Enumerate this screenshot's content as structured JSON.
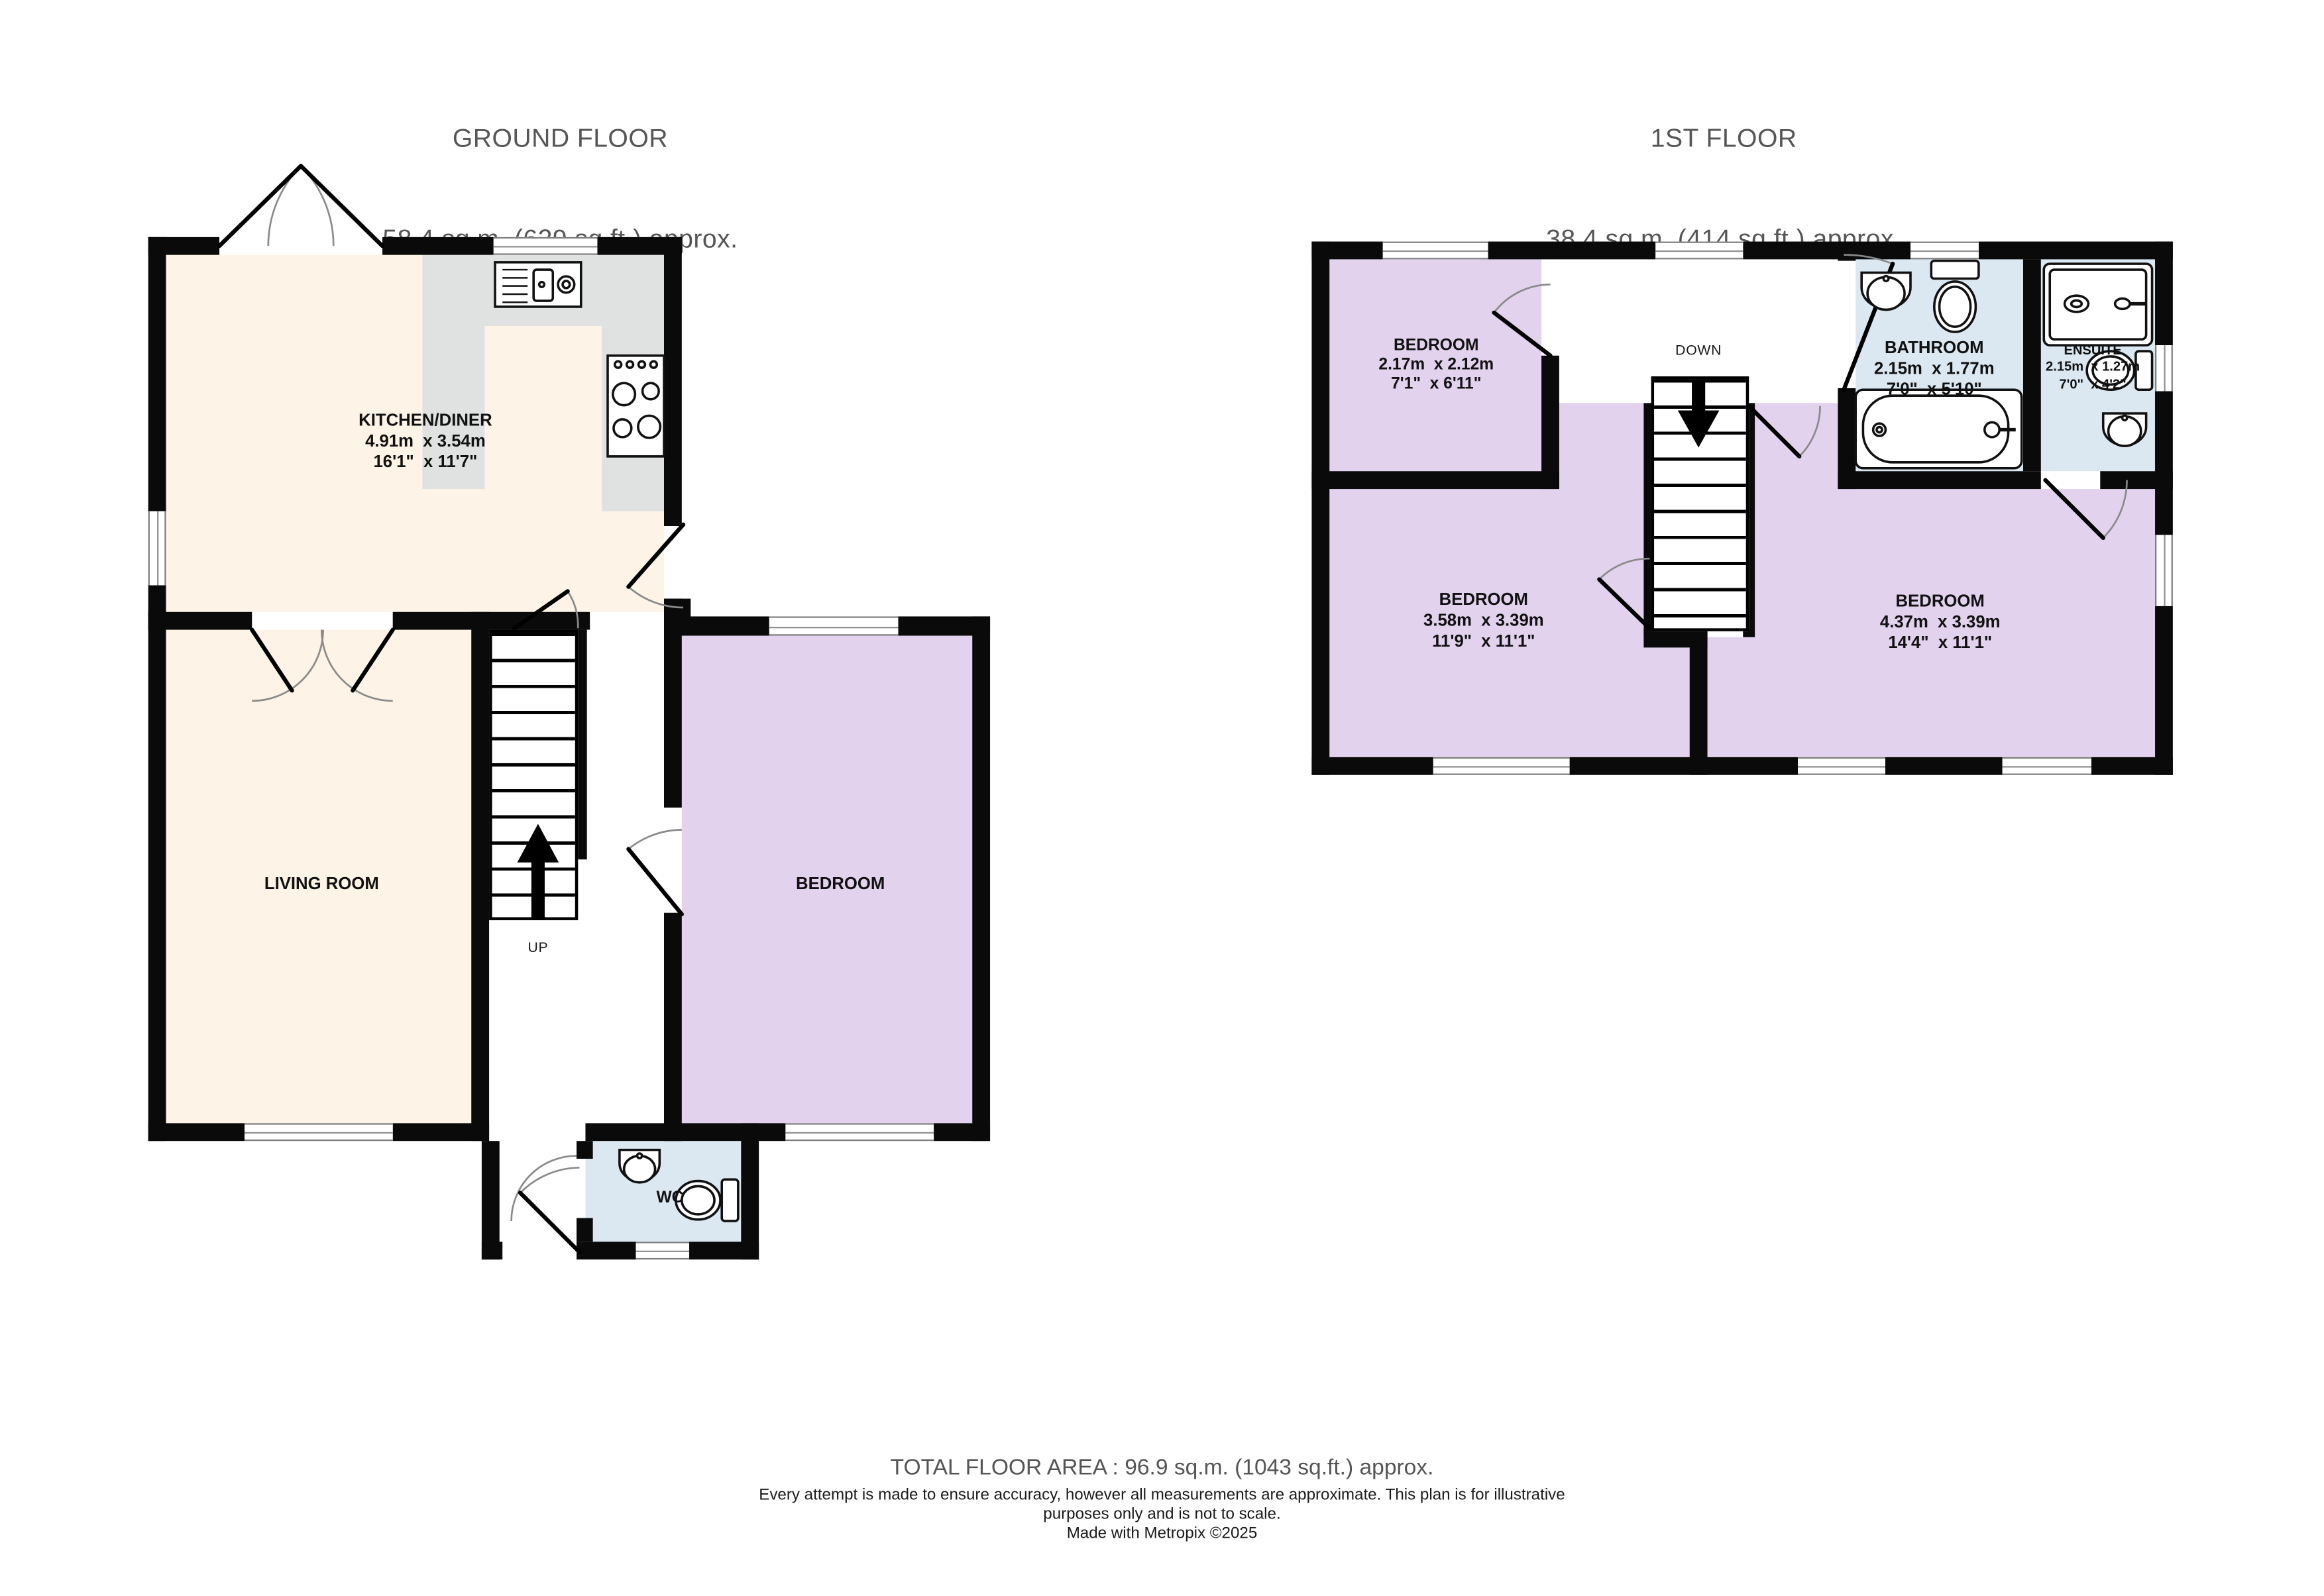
{
  "ground_floor": {
    "title": "GROUND FLOOR",
    "subtitle": "58.4 sq.m. (629 sq.ft.) approx.",
    "stairs_label": "UP",
    "rooms": {
      "kitchen": {
        "name": "KITCHEN/DINER",
        "metric": "4.91m  x 3.54m",
        "imperial": "16'1\"  x 11'7\""
      },
      "living": {
        "name": "LIVING ROOM"
      },
      "bedroom": {
        "name": "BEDROOM"
      },
      "wc": {
        "name": "WC"
      }
    }
  },
  "first_floor": {
    "title": "1ST FLOOR",
    "subtitle": "38.4 sq.m. (414 sq.ft.) approx.",
    "stairs_label": "DOWN",
    "rooms": {
      "bedroom1": {
        "name": "BEDROOM",
        "metric": "2.17m  x 2.12m",
        "imperial": "7'1\"  x 6'11\""
      },
      "bedroom2": {
        "name": "BEDROOM",
        "metric": "3.58m  x 3.39m",
        "imperial": "11'9\"  x 11'1\""
      },
      "bedroom3": {
        "name": "BEDROOM",
        "metric": "4.37m  x 3.39m",
        "imperial": "14'4\"  x 11'1\""
      },
      "bathroom": {
        "name": "BATHROOM",
        "metric": "2.15m  x 1.77m",
        "imperial": "7'0\"  x 5'10\""
      },
      "ensuite": {
        "name": "ENSUITE",
        "metric": "2.15m  x 1.27m",
        "imperial": "7'0\"  x 4'2\""
      }
    }
  },
  "footer": {
    "total_area": "TOTAL FLOOR AREA : 96.9 sq.m. (1043 sq.ft.) approx.",
    "disclaimer": "Every attempt is made to ensure accuracy, however all measurements are approximate. This plan is for illustrative purposes only and is not to scale.",
    "credit": "Made with Metropix ©2025"
  },
  "colors": {
    "wall": "#0a0a0a",
    "warm_room": "#fdf3e6",
    "purple_room": "#e2d2ee",
    "blue_room": "#dbe7f1",
    "counter": "#e0e2e2",
    "title_text": "#565656",
    "label_text": "#111111"
  }
}
